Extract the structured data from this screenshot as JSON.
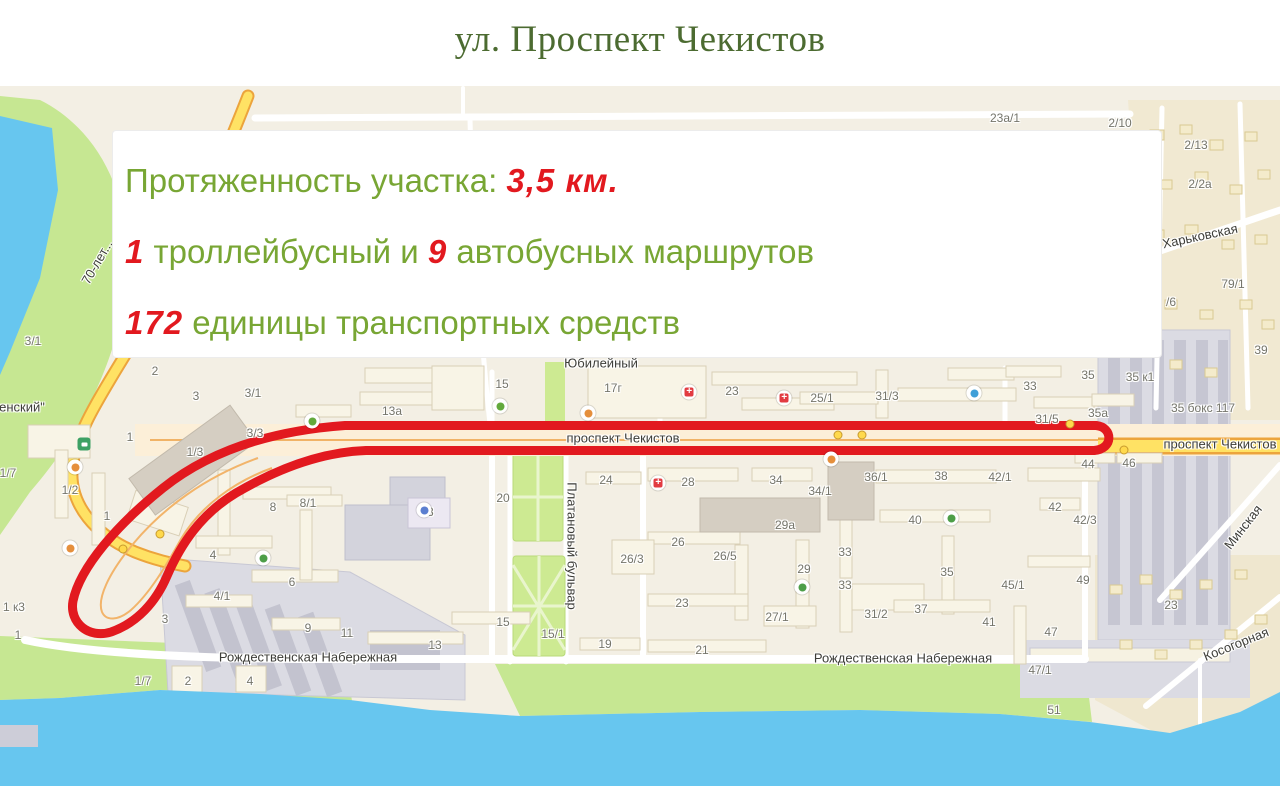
{
  "title": "ул. Проспект Чекистов",
  "colors": {
    "title_green": "#4c6b31",
    "text_green": "#78a634",
    "accent_red": "#e2191f",
    "route_red": "#e2191f",
    "water_blue": "#67c6ef",
    "park_green": "#c6e792",
    "road_yellow": "#ffe264",
    "map_beige": "#f3efe4"
  },
  "info_box": {
    "line1": {
      "label": "Протяженность участка: ",
      "value": "3,5 км."
    },
    "line2": {
      "num1": "1",
      "text1": " троллейбусный и ",
      "num2": "9",
      "text2": " автобусных маршрутов"
    },
    "line3": {
      "num": "172",
      "text": " единицы транспортных средств"
    }
  },
  "map": {
    "street_labels": [
      {
        "text": "проспект Чекистов",
        "x": 623,
        "y": 438,
        "rot": 0
      },
      {
        "text": "проспект Чекистов",
        "x": 1220,
        "y": 444,
        "rot": 0
      },
      {
        "text": "Рождественская Набережная",
        "x": 308,
        "y": 657,
        "rot": 0
      },
      {
        "text": "Рождественская Набережная",
        "x": 903,
        "y": 658,
        "rot": 0
      },
      {
        "text": "Платановый бульвар",
        "x": 572,
        "y": 546,
        "rot": 90
      },
      {
        "text": "Харьковская",
        "x": 1200,
        "y": 236,
        "rot": -12
      },
      {
        "text": "Минская",
        "x": 1243,
        "y": 527,
        "rot": -52
      },
      {
        "text": "Косогорная",
        "x": 1236,
        "y": 644,
        "rot": -22
      },
      {
        "text": "70-лет...",
        "x": 97,
        "y": 262,
        "rot": -60
      },
      {
        "text": "енский\"",
        "x": 22,
        "y": 407,
        "rot": 0
      },
      {
        "text": "Юбилейный",
        "x": 601,
        "y": 363,
        "rot": 0
      }
    ],
    "building_labels": [
      {
        "text": "13а",
        "x": 392,
        "y": 411
      },
      {
        "text": "15",
        "x": 502,
        "y": 384
      },
      {
        "text": "17г",
        "x": 613,
        "y": 388
      },
      {
        "text": "23",
        "x": 732,
        "y": 391
      },
      {
        "text": "25/1",
        "x": 822,
        "y": 398
      },
      {
        "text": "31/3",
        "x": 887,
        "y": 396
      },
      {
        "text": "33",
        "x": 1030,
        "y": 386
      },
      {
        "text": "35",
        "x": 1088,
        "y": 375
      },
      {
        "text": "35 к1",
        "x": 1140,
        "y": 377
      },
      {
        "text": "31/5",
        "x": 1047,
        "y": 419
      },
      {
        "text": "35а",
        "x": 1098,
        "y": 413
      },
      {
        "text": "35 бокс 117",
        "x": 1203,
        "y": 408
      },
      {
        "text": "23а/1",
        "x": 1005,
        "y": 118
      },
      {
        "text": "2/10",
        "x": 1120,
        "y": 123
      },
      {
        "text": "2/13",
        "x": 1196,
        "y": 145
      },
      {
        "text": "2/2а",
        "x": 1200,
        "y": 184
      },
      {
        "text": "79/1",
        "x": 1233,
        "y": 284
      },
      {
        "text": "/6",
        "x": 1171,
        "y": 302
      },
      {
        "text": "39",
        "x": 1261,
        "y": 350
      },
      {
        "text": "3/1",
        "x": 33,
        "y": 341
      },
      {
        "text": "2",
        "x": 155,
        "y": 371
      },
      {
        "text": "3",
        "x": 196,
        "y": 396
      },
      {
        "text": "3/1",
        "x": 253,
        "y": 393
      },
      {
        "text": "1",
        "x": 130,
        "y": 437
      },
      {
        "text": "1/3",
        "x": 195,
        "y": 452
      },
      {
        "text": "3/3",
        "x": 255,
        "y": 433
      },
      {
        "text": "1/7",
        "x": 8,
        "y": 473
      },
      {
        "text": "1/2",
        "x": 70,
        "y": 490
      },
      {
        "text": "1",
        "x": 107,
        "y": 516
      },
      {
        "text": "8",
        "x": 273,
        "y": 507
      },
      {
        "text": "8/1",
        "x": 308,
        "y": 503
      },
      {
        "text": "4",
        "x": 213,
        "y": 555
      },
      {
        "text": "6",
        "x": 292,
        "y": 582
      },
      {
        "text": "4/1",
        "x": 222,
        "y": 596
      },
      {
        "text": "3",
        "x": 165,
        "y": 619
      },
      {
        "text": "9",
        "x": 308,
        "y": 628
      },
      {
        "text": "1 к3",
        "x": 14,
        "y": 607
      },
      {
        "text": "1",
        "x": 18,
        "y": 635
      },
      {
        "text": "1/7",
        "x": 143,
        "y": 681
      },
      {
        "text": "2",
        "x": 188,
        "y": 681
      },
      {
        "text": "4",
        "x": 250,
        "y": 681
      },
      {
        "text": "20",
        "x": 503,
        "y": 498
      },
      {
        "text": "24",
        "x": 606,
        "y": 480
      },
      {
        "text": "18",
        "x": 427,
        "y": 512
      },
      {
        "text": "28",
        "x": 688,
        "y": 482
      },
      {
        "text": "34",
        "x": 776,
        "y": 480
      },
      {
        "text": "34/1",
        "x": 820,
        "y": 491
      },
      {
        "text": "36/1",
        "x": 876,
        "y": 477
      },
      {
        "text": "38",
        "x": 941,
        "y": 476
      },
      {
        "text": "42/1",
        "x": 1000,
        "y": 477
      },
      {
        "text": "40",
        "x": 915,
        "y": 520
      },
      {
        "text": "29а",
        "x": 785,
        "y": 525
      },
      {
        "text": "26",
        "x": 678,
        "y": 542
      },
      {
        "text": "26/5",
        "x": 725,
        "y": 556
      },
      {
        "text": "26/3",
        "x": 632,
        "y": 559
      },
      {
        "text": "29",
        "x": 804,
        "y": 569
      },
      {
        "text": "33",
        "x": 845,
        "y": 552
      },
      {
        "text": "33",
        "x": 845,
        "y": 585
      },
      {
        "text": "35",
        "x": 947,
        "y": 572
      },
      {
        "text": "45/1",
        "x": 1013,
        "y": 585
      },
      {
        "text": "42/3",
        "x": 1085,
        "y": 520
      },
      {
        "text": "42",
        "x": 1055,
        "y": 507
      },
      {
        "text": "23",
        "x": 682,
        "y": 603
      },
      {
        "text": "27/1",
        "x": 777,
        "y": 617
      },
      {
        "text": "31/2",
        "x": 876,
        "y": 614
      },
      {
        "text": "37",
        "x": 921,
        "y": 609
      },
      {
        "text": "41",
        "x": 989,
        "y": 622
      },
      {
        "text": "47",
        "x": 1051,
        "y": 632
      },
      {
        "text": "21",
        "x": 702,
        "y": 650
      },
      {
        "text": "47/1",
        "x": 1040,
        "y": 670
      },
      {
        "text": "11",
        "x": 347,
        "y": 633
      },
      {
        "text": "13",
        "x": 435,
        "y": 645
      },
      {
        "text": "15",
        "x": 503,
        "y": 622
      },
      {
        "text": "15/1",
        "x": 553,
        "y": 634
      },
      {
        "text": "19",
        "x": 605,
        "y": 644
      },
      {
        "text": "44",
        "x": 1088,
        "y": 464
      },
      {
        "text": "46",
        "x": 1129,
        "y": 463
      },
      {
        "text": "49",
        "x": 1083,
        "y": 580
      },
      {
        "text": "23",
        "x": 1171,
        "y": 605
      },
      {
        "text": "51",
        "x": 1054,
        "y": 710
      }
    ],
    "pois": [
      {
        "type": "cross",
        "x": 689,
        "y": 392
      },
      {
        "type": "cross",
        "x": 784,
        "y": 398
      },
      {
        "type": "cross",
        "x": 658,
        "y": 483
      },
      {
        "type": "cafe",
        "x": 588,
        "y": 413
      },
      {
        "type": "cafe",
        "x": 831,
        "y": 459
      },
      {
        "type": "cafe",
        "x": 75,
        "y": 467
      },
      {
        "type": "cafe",
        "x": 70,
        "y": 548
      },
      {
        "type": "cart",
        "x": 500,
        "y": 406
      },
      {
        "type": "cart",
        "x": 312,
        "y": 421
      },
      {
        "type": "pool",
        "x": 974,
        "y": 393
      },
      {
        "type": "tree",
        "x": 951,
        "y": 518
      },
      {
        "type": "tree",
        "x": 263,
        "y": 558
      },
      {
        "type": "tree",
        "x": 802,
        "y": 587
      },
      {
        "type": "school",
        "x": 424,
        "y": 510
      },
      {
        "type": "bus",
        "x": 84,
        "y": 444
      },
      {
        "type": "dot",
        "x": 838,
        "y": 435
      },
      {
        "type": "dot",
        "x": 862,
        "y": 435
      },
      {
        "type": "dot",
        "x": 1070,
        "y": 424
      },
      {
        "type": "dot",
        "x": 1124,
        "y": 450
      },
      {
        "type": "dot",
        "x": 123,
        "y": 549
      },
      {
        "type": "dot",
        "x": 160,
        "y": 534
      }
    ]
  }
}
